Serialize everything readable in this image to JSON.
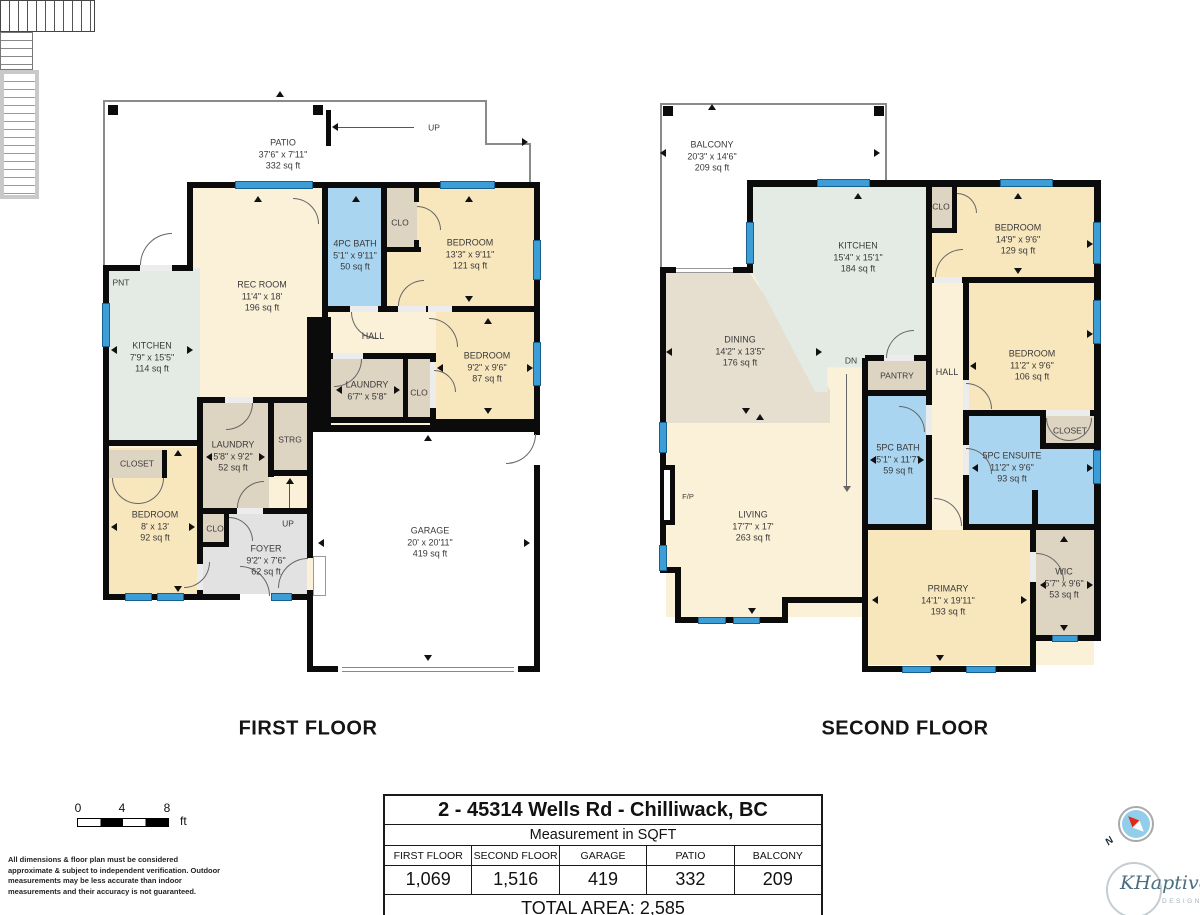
{
  "f1": {
    "label": "FIRST FLOOR",
    "patio": {
      "name": "PATIO",
      "dims": "37'6\" x 7'11\"",
      "area": "332 sq ft"
    },
    "up_top": "UP",
    "rec": {
      "name": "REC ROOM",
      "dims": "11'4\" x 18'",
      "area": "196 sq ft"
    },
    "bath": {
      "name": "4PC BATH",
      "dims": "5'1\" x 9'11\"",
      "area": "50 sq ft"
    },
    "clo1": "CLO",
    "bed1": {
      "name": "BEDROOM",
      "dims": "13'3\" x 9'11\"",
      "area": "121 sq ft"
    },
    "pnt": "PNT",
    "kitchen": {
      "name": "KITCHEN",
      "dims": "7'9\" x 15'5\"",
      "area": "114 sq ft"
    },
    "hall": "HALL",
    "laundry2": {
      "name": "LAUNDRY",
      "dims": "6'7\" x 5'8\""
    },
    "clo2": "CLO",
    "bed2": {
      "name": "BEDROOM",
      "dims": "9'2\" x 9'6\"",
      "area": "87 sq ft"
    },
    "laundry1": {
      "name": "LAUNDRY",
      "dims": "5'8\" x 9'2\"",
      "area": "52 sq ft"
    },
    "strg": "STRG",
    "closet": "CLOSET",
    "bed3": {
      "name": "BEDROOM",
      "dims": "8' x 13'",
      "area": "92 sq ft"
    },
    "clo3": "CLO",
    "up_foyer": "UP",
    "foyer": {
      "name": "FOYER",
      "dims": "9'2\" x 7'6\"",
      "area": "62 sq ft"
    },
    "garage": {
      "name": "GARAGE",
      "dims": "20' x 20'11\"",
      "area": "419 sq ft"
    }
  },
  "f2": {
    "label": "SECOND FLOOR",
    "balcony": {
      "name": "BALCONY",
      "dims": "20'3\" x 14'6\"",
      "area": "209 sq ft"
    },
    "kitchen": {
      "name": "KITCHEN",
      "dims": "15'4\" x 15'1\"",
      "area": "184 sq ft"
    },
    "clo4": "CLO",
    "bed4": {
      "name": "BEDROOM",
      "dims": "14'9\" x 9'6\"",
      "area": "129 sq ft"
    },
    "dining": {
      "name": "DINING",
      "dims": "14'2\" x 13'5\"",
      "area": "176 sq ft"
    },
    "dn": "DN",
    "pantry": "PANTRY",
    "hall": "HALL",
    "bed5": {
      "name": "BEDROOM",
      "dims": "11'2\" x 9'6\"",
      "area": "106 sq ft"
    },
    "bath": {
      "name": "5PC BATH",
      "dims": "5'1\" x 11'7\"",
      "area": "59 sq ft"
    },
    "ensuite": {
      "name": "5PC ENSUITE",
      "dims": "11'2\" x 9'6\"",
      "area": "93 sq ft"
    },
    "closet2": "CLOSET",
    "fp": "F/P",
    "living": {
      "name": "LIVING",
      "dims": "17'7\" x 17'",
      "area": "263 sq ft"
    },
    "primary": {
      "name": "PRIMARY",
      "dims": "14'1\" x 19'11\"",
      "area": "193 sq ft"
    },
    "wic": {
      "name": "WIC",
      "dims": "5'7\" x 9'6\"",
      "area": "53 sq ft"
    }
  },
  "title_block": {
    "address": "2 - 45314 Wells Rd - Chilliwack, BC",
    "subtitle": "Measurement in SQFT",
    "columns": [
      {
        "label": "FIRST FLOOR",
        "value": "1,069"
      },
      {
        "label": "SECOND FLOOR",
        "value": "1,516"
      },
      {
        "label": "GARAGE",
        "value": "419"
      },
      {
        "label": "PATIO",
        "value": "332"
      },
      {
        "label": "BALCONY",
        "value": "209"
      }
    ],
    "total": "TOTAL AREA: 2,585"
  },
  "scale": {
    "t0": "0",
    "t4": "4",
    "t8": "8",
    "unit": "ft"
  },
  "disclaimer": "All dimensions & floor plan must be considered approximate & subject to independent verification.  Outdoor measurements may be less accurate than indoor measurements and their accuracy is not guaranteed.",
  "compass": {
    "n": "N"
  },
  "logo": {
    "name": "KHaptive",
    "sub": "DESIGN"
  },
  "colors": {
    "wall": "#0b0b0b",
    "window": "#3d9dd6",
    "bath": "#a9d5f0",
    "bedroom": "#f8e7bd",
    "cream": "#fbf1d8",
    "kitchen": "#e4ebe4",
    "dining": "#e6dfd0",
    "storage_tan": "#ded4c2",
    "foyer": "#e2e2e3"
  }
}
